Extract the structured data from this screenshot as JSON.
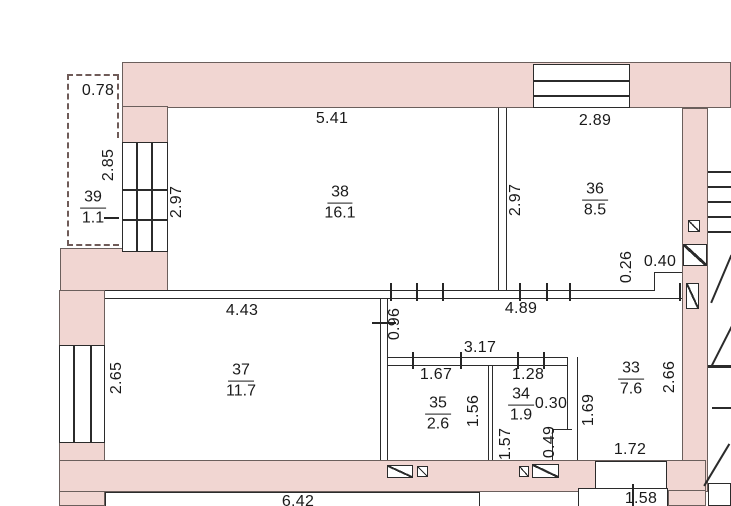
{
  "plan": {
    "type": "floor-plan",
    "rooms": [
      {
        "number": "39",
        "area": "1.1",
        "cx": 93,
        "cy": 208
      },
      {
        "number": "38",
        "area": "16.1",
        "cx": 340,
        "cy": 203
      },
      {
        "number": "36",
        "area": "8.5",
        "cx": 595,
        "cy": 200
      },
      {
        "number": "37",
        "area": "11.7",
        "cx": 241,
        "cy": 381
      },
      {
        "number": "35",
        "area": "2.6",
        "cx": 438,
        "cy": 414
      },
      {
        "number": "34",
        "area": "1.9",
        "cx": 521,
        "cy": 405
      },
      {
        "number": "33",
        "area": "7.6",
        "cx": 631,
        "cy": 379
      }
    ],
    "dimensions": [
      {
        "v": "0.78",
        "x": 98,
        "y": 91,
        "rot": 0
      },
      {
        "v": "2.85",
        "x": 109,
        "y": 165,
        "rot": -90
      },
      {
        "v": "2.97",
        "x": 177,
        "y": 202,
        "rot": -90
      },
      {
        "v": "5.41",
        "x": 332,
        "y": 119,
        "rot": 0
      },
      {
        "v": "2.89",
        "x": 595,
        "y": 121,
        "rot": 0
      },
      {
        "v": "2.97",
        "x": 516,
        "y": 200,
        "rot": -90
      },
      {
        "v": "0.26",
        "x": 627,
        "y": 267,
        "rot": -90
      },
      {
        "v": "0.40",
        "x": 660,
        "y": 262,
        "rot": 0
      },
      {
        "v": "4.43",
        "x": 242,
        "y": 311,
        "rot": 0
      },
      {
        "v": "4.89",
        "x": 521,
        "y": 309,
        "rot": 0
      },
      {
        "v": "0.96",
        "x": 395,
        "y": 324,
        "rot": -90
      },
      {
        "v": "2.65",
        "x": 117,
        "y": 378,
        "rot": -90
      },
      {
        "v": "3.17",
        "x": 480,
        "y": 348,
        "rot": 0
      },
      {
        "v": "1.67",
        "x": 436,
        "y": 375,
        "rot": 0
      },
      {
        "v": "1.28",
        "x": 528,
        "y": 375,
        "rot": 0
      },
      {
        "v": "1.56",
        "x": 474,
        "y": 411,
        "rot": -90
      },
      {
        "v": "0.30",
        "x": 551,
        "y": 404,
        "rot": 0
      },
      {
        "v": "1.57",
        "x": 506,
        "y": 444,
        "rot": -90
      },
      {
        "v": "0.49",
        "x": 550,
        "y": 442,
        "rot": -90
      },
      {
        "v": "1.69",
        "x": 589,
        "y": 410,
        "rot": -90
      },
      {
        "v": "2.66",
        "x": 670,
        "y": 377,
        "rot": -90
      },
      {
        "v": "1.72",
        "x": 630,
        "y": 450,
        "rot": 0
      },
      {
        "v": "6.42",
        "x": 298,
        "y": 502,
        "rot": 0
      },
      {
        "v": "1.58",
        "x": 641,
        "y": 499,
        "rot": 0
      }
    ]
  },
  "colors": {
    "wall_fill": "#f1d6d2",
    "line": "#2b2b2b",
    "balcony_dash": "#6f5b58",
    "background": "#ffffff",
    "text": "#1a1a1a"
  }
}
